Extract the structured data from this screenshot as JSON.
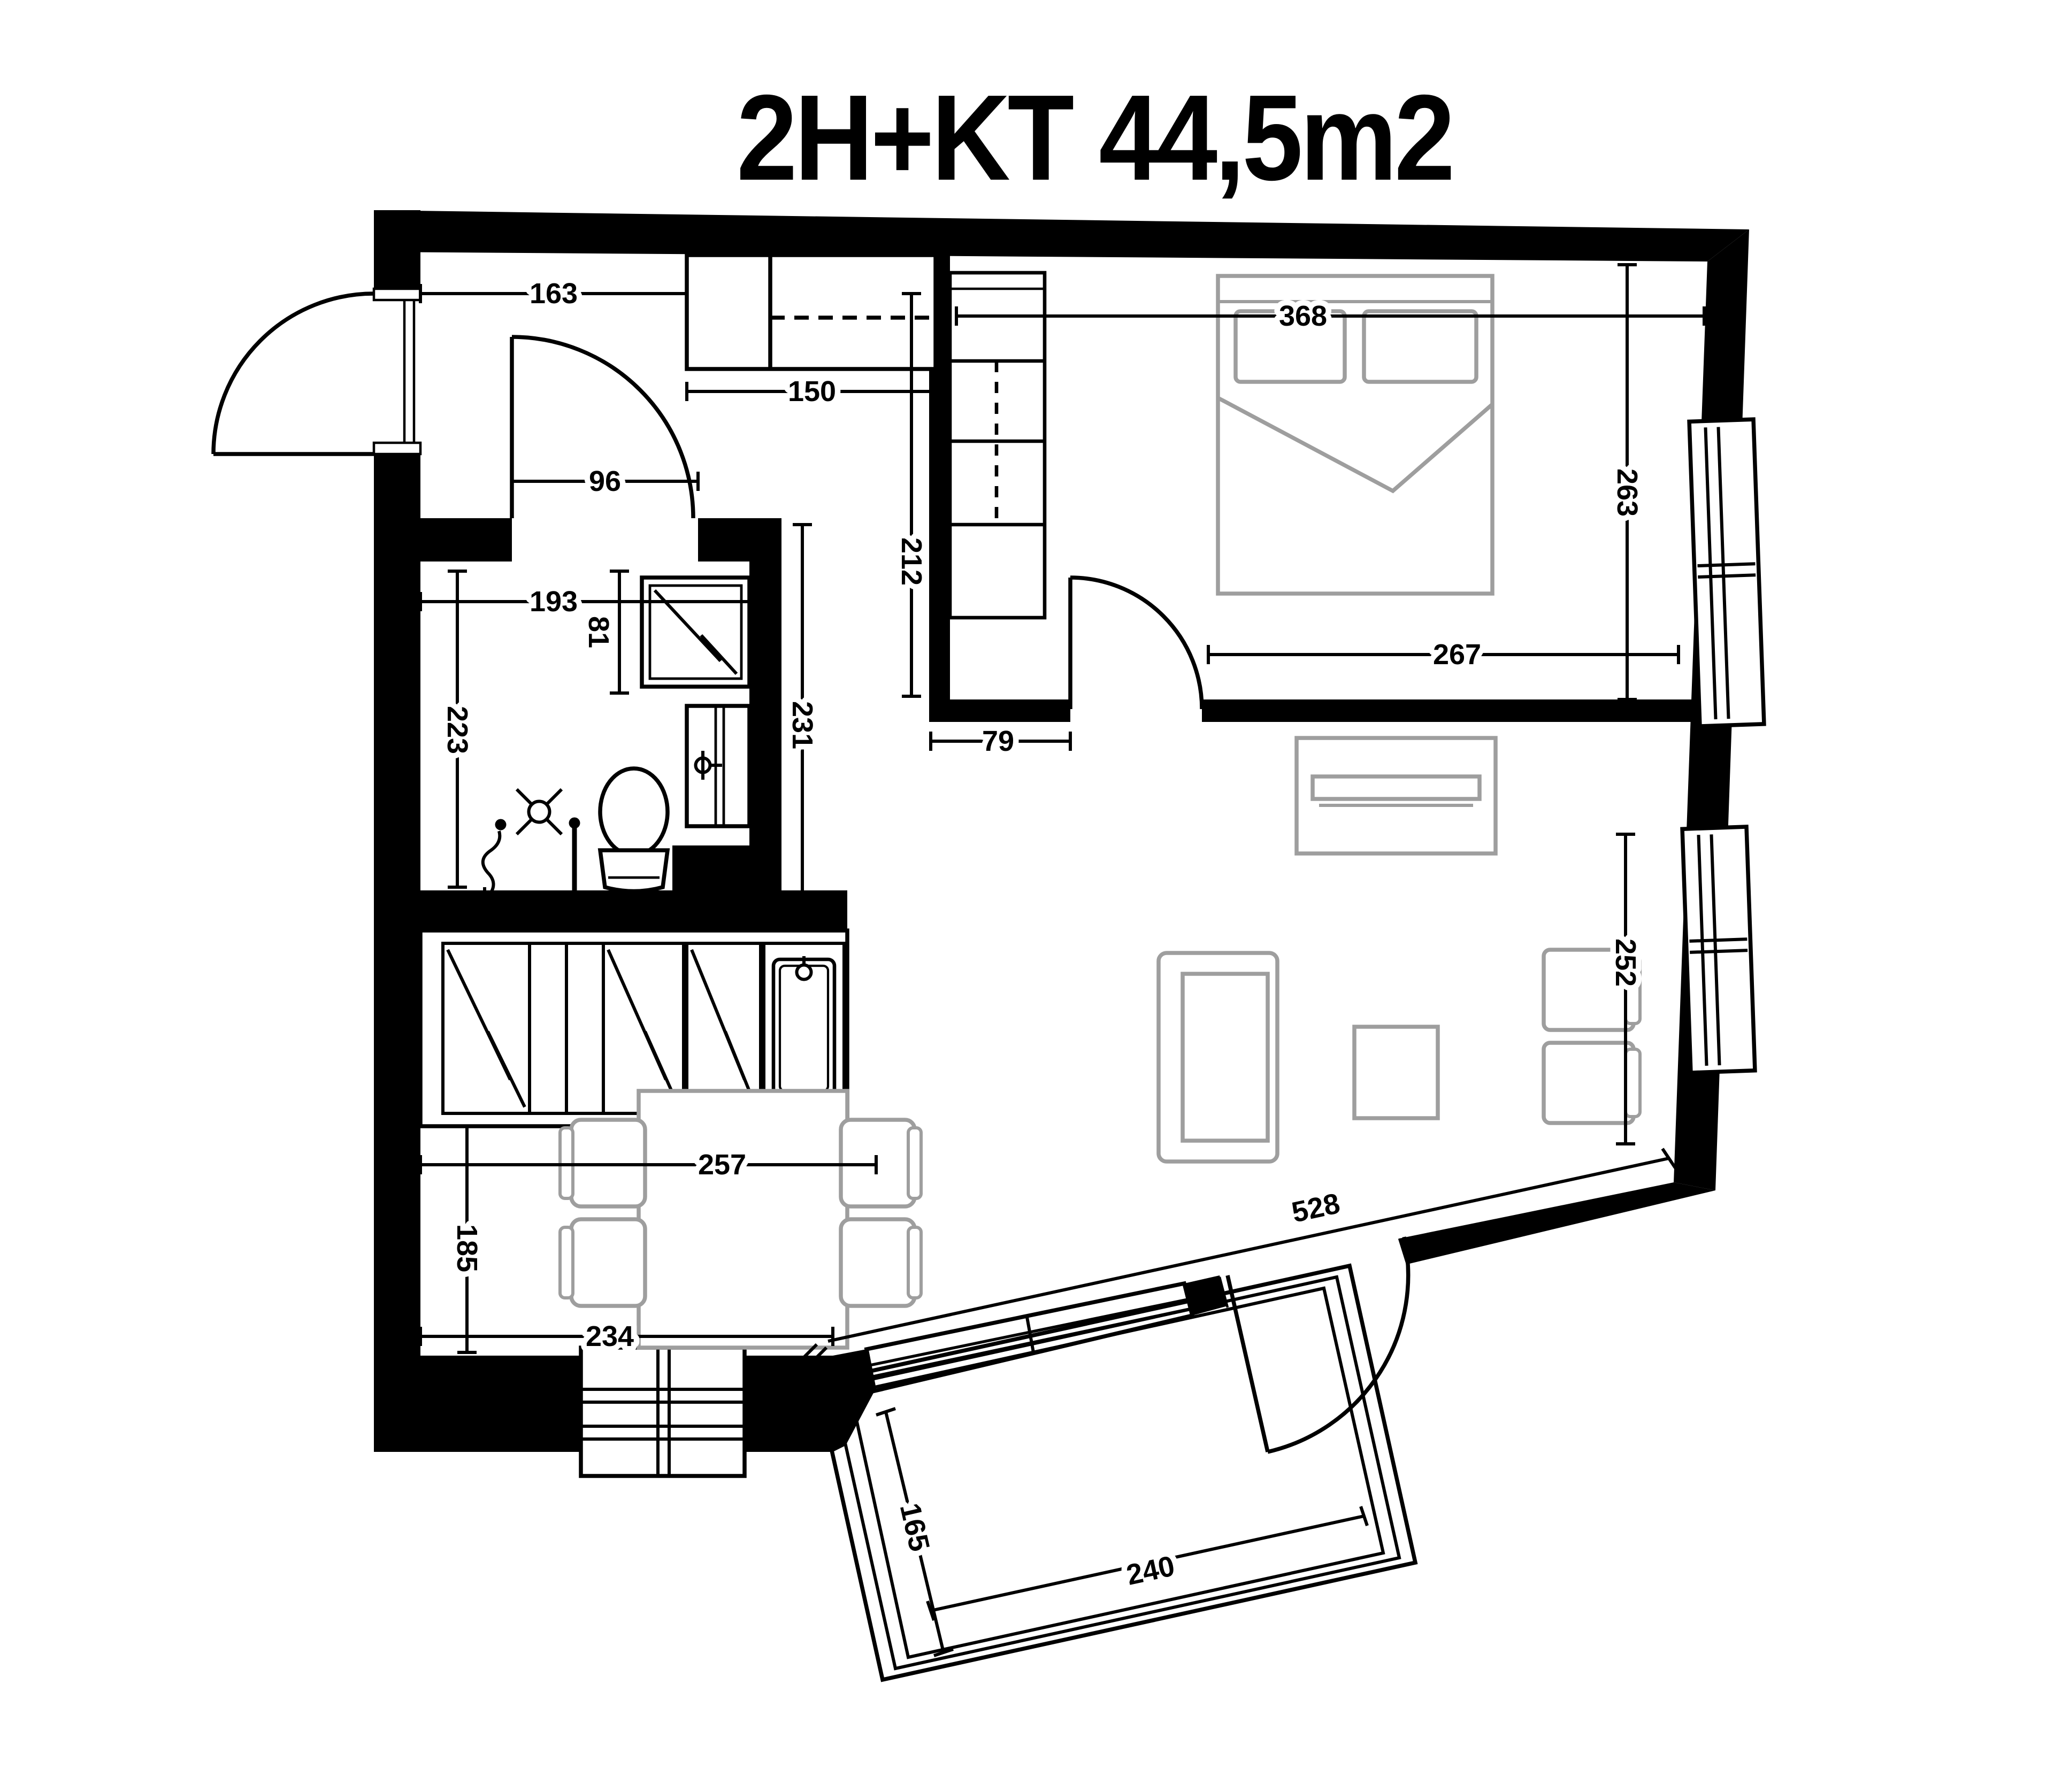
{
  "title": "2H+KT 44,5m2",
  "floorplan": {
    "dimensions": {
      "hall_entry_width": "163",
      "kitchen_upper_cabinets": "150",
      "bathroom_door_width": "96",
      "bathroom_width": "193",
      "shower_width": "81",
      "bathroom_depth_left": "223",
      "kitchen_wall_depth": "231",
      "hall_corridor_depth": "212",
      "bedroom_width": "368",
      "bedroom_depth": "263",
      "bedroom_bottom_wall": "267",
      "bedroom_left_wall": "79",
      "living_window_wall": "252",
      "kitchen_counter_run": "257",
      "dining_zone_depth": "185",
      "dining_zone_width": "234",
      "living_diagonal_wall": "528",
      "balcony_depth": "165",
      "balcony_width": "240"
    }
  }
}
